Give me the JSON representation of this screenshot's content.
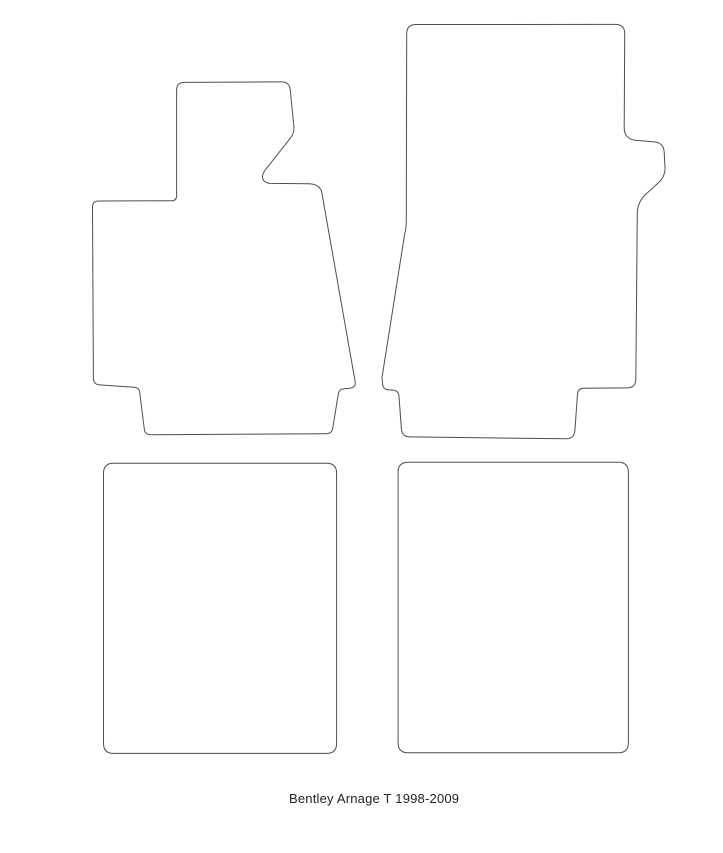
{
  "canvas": {
    "background": "#ffffff",
    "outline_color": "#4f4f4f",
    "outline_width": 1
  },
  "caption": {
    "text": "Bentley Arnage T 1998-2009",
    "color": "#222222"
  },
  "mats": [
    {
      "id": "front-driver-mat",
      "label": "Front driver mat outline with footrest extension",
      "path": "M 92.5 207 Q 92.3 201.2 98.3 201 L 171.5 200.8 Q 176.6 200.7 176.6 195.7 L 176.6 90 Q 176.6 82.6 184 82.4 L 281.5 81.9 Q 289.6 81.9 290.2 89.8 L 293.9 126.5 Q 294.6 132.8 290.2 138.3 L 265.6 169.6 C 260.8 175.8 261.2 181.8 269.3 183.4 L 309.5 183.8 Q 319.3 184.2 321.7 192 L 355.1 381.3 Q 356.2 387.6 349.6 388.3 L 343.6 388.9 Q 338.9 389.4 338.3 394 L 332.7 428.4 Q 331.8 433.6 326 433.7 L 150.8 434.8 Q 144.9 434.8 144.3 429 L 139.7 392.3 Q 139 387.6 134.2 387.3 L 99.6 384.9 Q 93.7 384.5 93.4 378.6 L 92.5 207 Z"
    },
    {
      "id": "front-passenger-mat",
      "label": "Front passenger mat outline with side lug",
      "path": "M 406.7 33.8 Q 406.7 24.6 415.9 24.5 L 615.4 24.4 Q 624.7 24.4 624.7 33.6 L 624.2 128 Q 624.4 138.6 634.8 140.2 L 654.2 141.9 Q 663.6 142.8 664.2 152.2 L 665 167.5 Q 665.4 176.4 658.6 182.6 L 646.5 193.6 Q 637.4 201.5 637.3 213.5 L 635.8 379.5 Q 635.7 387.7 627.2 387.9 L 583.6 388.3 Q 577.9 388.4 577.5 394 L 574.9 430.6 Q 574.3 438.6 566.2 438.8 L 409.8 436.9 Q 402 436.7 401.4 428.9 L 399 396.3 Q 398.6 390.3 392.5 390.1 L 388.8 389.9 Q 382.9 389.6 382.5 383.6 L 382 377.5 L 404.6 234.5 C 406.5 227 406.3 222 406.3 214 L 406.7 33.8 Z"
    },
    {
      "id": "rear-left-mat",
      "label": "Rear left mat outline",
      "path": "M 113.5 463.2 L 326.6 463.2 Q 336.6 463.2 336.6 473.2 L 336.6 743.4 Q 336.6 753.4 326.6 753.4 L 113.5 753.4 Q 103.5 753.4 103.5 743.4 L 103.5 473.2 Q 103.5 463.2 113.5 463.2 Z"
    },
    {
      "id": "rear-right-mat",
      "label": "Rear right mat outline",
      "path": "M 408.1 462.3 L 618.4 462.3 Q 628.4 462.3 628.4 472.3 L 628.4 742.8 Q 628.4 752.8 618.4 752.8 L 408.1 752.8 Q 398.1 752.8 398.1 742.8 L 398.1 472.3 Q 398.1 462.3 408.1 462.3 Z"
    }
  ]
}
